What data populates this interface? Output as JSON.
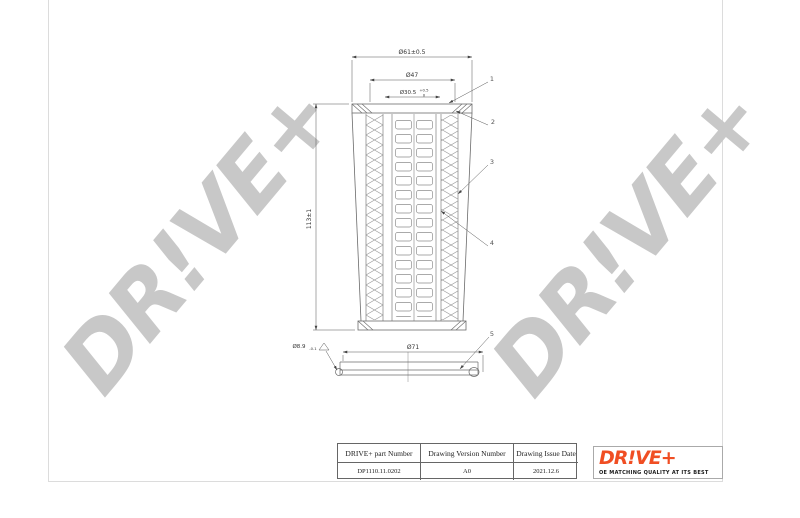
{
  "page": {
    "background": "#ffffff",
    "border_color": "#dcdcdc"
  },
  "watermarks": [
    {
      "text": "DR!VE+"
    },
    {
      "text": "DR!VE+"
    }
  ],
  "drawing": {
    "dimensions": {
      "top_outer": "Ø61±0.5",
      "top_mid": "Ø47",
      "top_inner_main": "Ø30.5",
      "top_inner_sup": "+0.5",
      "top_inner_sub": "0",
      "height": "113±1",
      "bottom_width": "Ø71",
      "bottom_hole_main": "Ø8.9",
      "bottom_hole_sub": "-0.1",
      "triangle_symbol": "△"
    },
    "callouts": [
      "1",
      "2",
      "3",
      "4",
      "5"
    ]
  },
  "title_block": {
    "headers": [
      "DRIVE+ part Number",
      "Drawing Version Number",
      "Drawing Issue Date"
    ],
    "values": [
      "DP1110.11.0202",
      "A0",
      "2021.12.6"
    ]
  },
  "logo": {
    "brand": "DR!VE+",
    "tagline": "OE MATCHING QUALITY AT ITS BEST",
    "color": "#f04e23"
  }
}
